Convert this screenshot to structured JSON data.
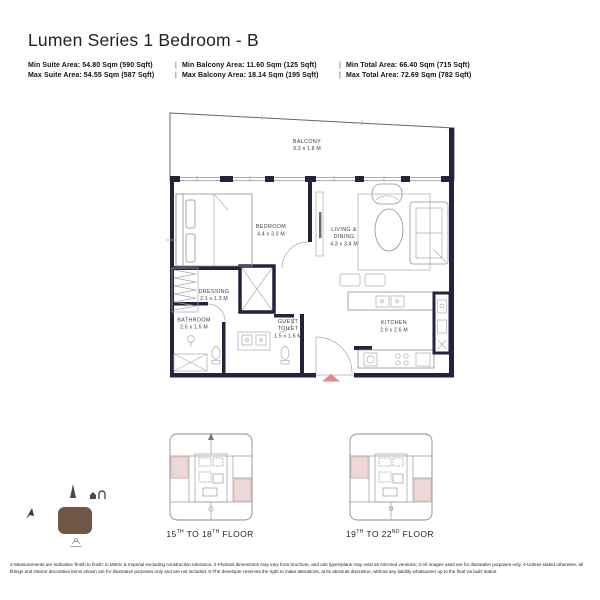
{
  "header": {
    "title": "Lumen Series 1 Bedroom - B",
    "separator": "|",
    "stats_rows": [
      {
        "items": [
          "Min Suite Area: 54.80 Sqm (590 Sqft)",
          "Min Balcony Area: 11.60 Sqm (125 Sqft)",
          "Min Total Area: 66.40 Sqm (715 Sqft)"
        ]
      },
      {
        "items": [
          "Max Suite Area: 54.55 Sqm (587 Sqft)",
          "Max Balcony Area: 18.14 Sqm (195 Sqft)",
          "Max Total Area: 72.69 Sqm (782 Sqft)"
        ]
      }
    ]
  },
  "floor_plan": {
    "rooms": {
      "balcony": {
        "lines": [
          "BALCONY",
          "9.3 x 1.8 M"
        ]
      },
      "bedroom": {
        "lines": [
          "BEDROOM",
          "4.4 x 3.0 M"
        ]
      },
      "living_dining": {
        "lines": [
          "LIVING &",
          "DINING",
          "4.3 x 3.4 M"
        ]
      },
      "dressing": {
        "lines": [
          "DRESSING",
          "2.1 x 1.3 M"
        ]
      },
      "bathroom": {
        "lines": [
          "BATHROOM",
          "2.5 x 1.5 M"
        ]
      },
      "guest_toilet": {
        "lines": [
          "GUEST",
          "TOILET",
          "1.5 x 1.6 M"
        ]
      },
      "kitchen": {
        "lines": [
          "KITCHEN",
          "2.9 x 2.6 M"
        ]
      }
    },
    "colors": {
      "wall": "#23233e",
      "entrance_arrow": "#e58784",
      "furniture_line": "#8f8f9d"
    }
  },
  "key_plans": [
    {
      "label_parts": [
        "15",
        "TH",
        " TO 18",
        "TH",
        " FLOOR"
      ],
      "highlight_color": "#eed8d7"
    },
    {
      "label_parts": [
        "19",
        "TH",
        " TO 22",
        "ND",
        " FLOOR"
      ],
      "highlight_color": "#eed8d7"
    }
  ],
  "location_map": {
    "marker_color": "#6e5747"
  },
  "footer": {
    "disclaimer": "1-Measurements are indicative 'finish to finish' in Metric & Imperial excluding construction tolerance. 2-Plot/unit dimensions may vary from brochure, and unit types/plans may exist as mirrored versions; 3-All images used are for illustrative purposes only. 4-Unless stated otherwise, all fittings and interior decorative items shown are for illustrative purposes only and are not included. 5-The developer reserves the right to make alterations, at its absolute discretion, without any liability whatsoever up to the final 'as built' status."
  }
}
